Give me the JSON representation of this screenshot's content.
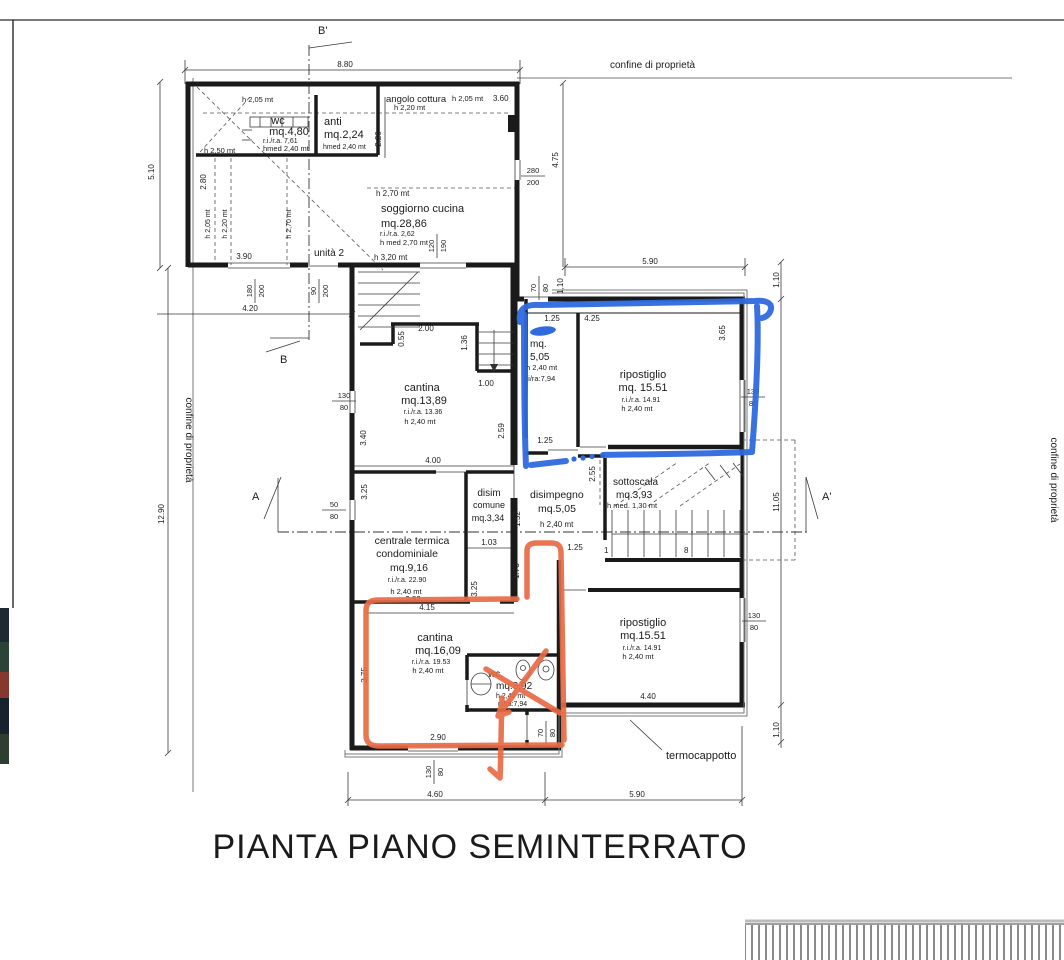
{
  "title": "PIANTA PIANO SEMINTERRATO",
  "colors": {
    "blue_marker": "#2f6bdf",
    "orange_marker": "#e96a44"
  },
  "boundary": {
    "top": "confine di proprietà",
    "left": "confine di proprietà",
    "right": "confine di proprietà"
  },
  "callouts": {
    "termocappotto": "termocappotto",
    "unit": "unità 2"
  },
  "sections": {
    "b_top": "B'",
    "b_bottom": "B",
    "a_left": "A",
    "a_right": "A'"
  },
  "stairs": {
    "first_step": "1",
    "last_step": "8"
  },
  "rooms": {
    "wc1": {
      "name": "wc",
      "area": "mq.4,80",
      "rira": "r.i./r.a. 7,61",
      "h": "hmed  2,40 mt",
      "h_top": "h  2,05 mt",
      "h_left": "h  2,50 mt"
    },
    "anti": {
      "name": "anti",
      "area": "mq.2,24",
      "h": "hmed  2,40 mt"
    },
    "angolo": {
      "name": "angolo cottura",
      "h1": "h  2,05 mt",
      "w": "3.60",
      "h2": "h  2,20 mt"
    },
    "soggiorno": {
      "h_top": "h  2,70 mt",
      "name": "soggiorno cucina",
      "area": "mq.28,86",
      "rira": "r.i./r.a. 2,62",
      "h": "h  med 2,70 mt",
      "h_door": "h  3,20 mt"
    },
    "cantina1": {
      "name": "cantina",
      "area": "mq.13,89",
      "rira": "r.i./r.a. 13.36",
      "h": "h  2,40 mt"
    },
    "mq505": {
      "l1": "mq.",
      "l2": "5,05",
      "h": "h  2,40 mt",
      "rira": "r.i/ra:7,94"
    },
    "rip_top": {
      "name": "ripostiglio",
      "area": "mq. 15.51",
      "rira": "r.i./r.a. 14.91",
      "h": "h  2,40 mt"
    },
    "sottoscala": {
      "name": "sottoscala",
      "area": "mq.3,93",
      "h": "h  med. 1,30 mt"
    },
    "disim": {
      "l1": "disim",
      "l2": "comune",
      "area": "mq.3,34"
    },
    "disimpegno": {
      "name": "disimpegno",
      "area": "mq.5,05",
      "h": "h  2,40 mt"
    },
    "centrale": {
      "l1": "centrale termica",
      "l2": "condominiale",
      "area": "mq.9,16",
      "rira": "r.i./r.a. 22.90",
      "h": "h  2,40 mt"
    },
    "cantina2": {
      "name": "cantina",
      "area": "mq.16,09",
      "rira": "r.i./r.a. 19.53",
      "h": "h  2,40 mt"
    },
    "wc2": {
      "name": "wc.",
      "area": "mq.3,92",
      "h": "h  2,40 mt",
      "rira": "r.i/ra:7,94"
    },
    "rip_bottom": {
      "name": "ripostiglio",
      "area": "mq.15.51",
      "rira": "r.i./r.a. 14.91",
      "h": "h  2,40 mt"
    }
  },
  "dims": {
    "w880": "8.80",
    "h510": "5.10",
    "h1290": "12.90",
    "w420": "4.20",
    "w390": "3.90",
    "r280": "2.80",
    "rh205": "h 2,05 mt",
    "rh220": "h 2,20 mt",
    "rh270": "h 2,70 mt",
    "v220": "2.20",
    "v475": "4.75",
    "w590top": "5.90",
    "v110top": "1,10",
    "v110rt": "1,10",
    "v1105": "11.05",
    "v110rb": "1,10",
    "d055": "0.55",
    "d200": "2.00",
    "d136": "1.36",
    "d100": "1.00",
    "d259": "2.59",
    "d340": "3.40",
    "d400": "4.00",
    "d125a": "1.25",
    "d425": "4.25",
    "d365": "3.65",
    "d125b": "1.25",
    "d255": "2.55",
    "d152": "1.52",
    "d103": "1.03",
    "d125c": "1.25",
    "d173": "1.73",
    "d325a": "3.25",
    "d325b": "3.25",
    "d282": "2.82",
    "d415": "4.15",
    "d375": "3.75",
    "d290": "2.90",
    "d440": "4.40",
    "w460": "4.60",
    "w590bottom": "5.90"
  },
  "fractions": {
    "f280_200": {
      "n": "280",
      "d": "200"
    },
    "f180_200": {
      "n": "180",
      "d": "200"
    },
    "f90_200": {
      "n": "90",
      "d": "200"
    },
    "f120_190": {
      "n": "120",
      "d": "190"
    },
    "f130_80a": {
      "n": "130",
      "d": "80"
    },
    "f130_80b": {
      "n": "130",
      "d": "80"
    },
    "f50_80": {
      "n": "50",
      "d": "80"
    },
    "f70_80a": {
      "n": "70",
      "d": "80"
    },
    "f130_80c": {
      "n": "130",
      "d": "80"
    },
    "f70_80d": {
      "n": "70",
      "d": "80"
    },
    "f130_80e": {
      "n": "130",
      "d": "80"
    }
  }
}
